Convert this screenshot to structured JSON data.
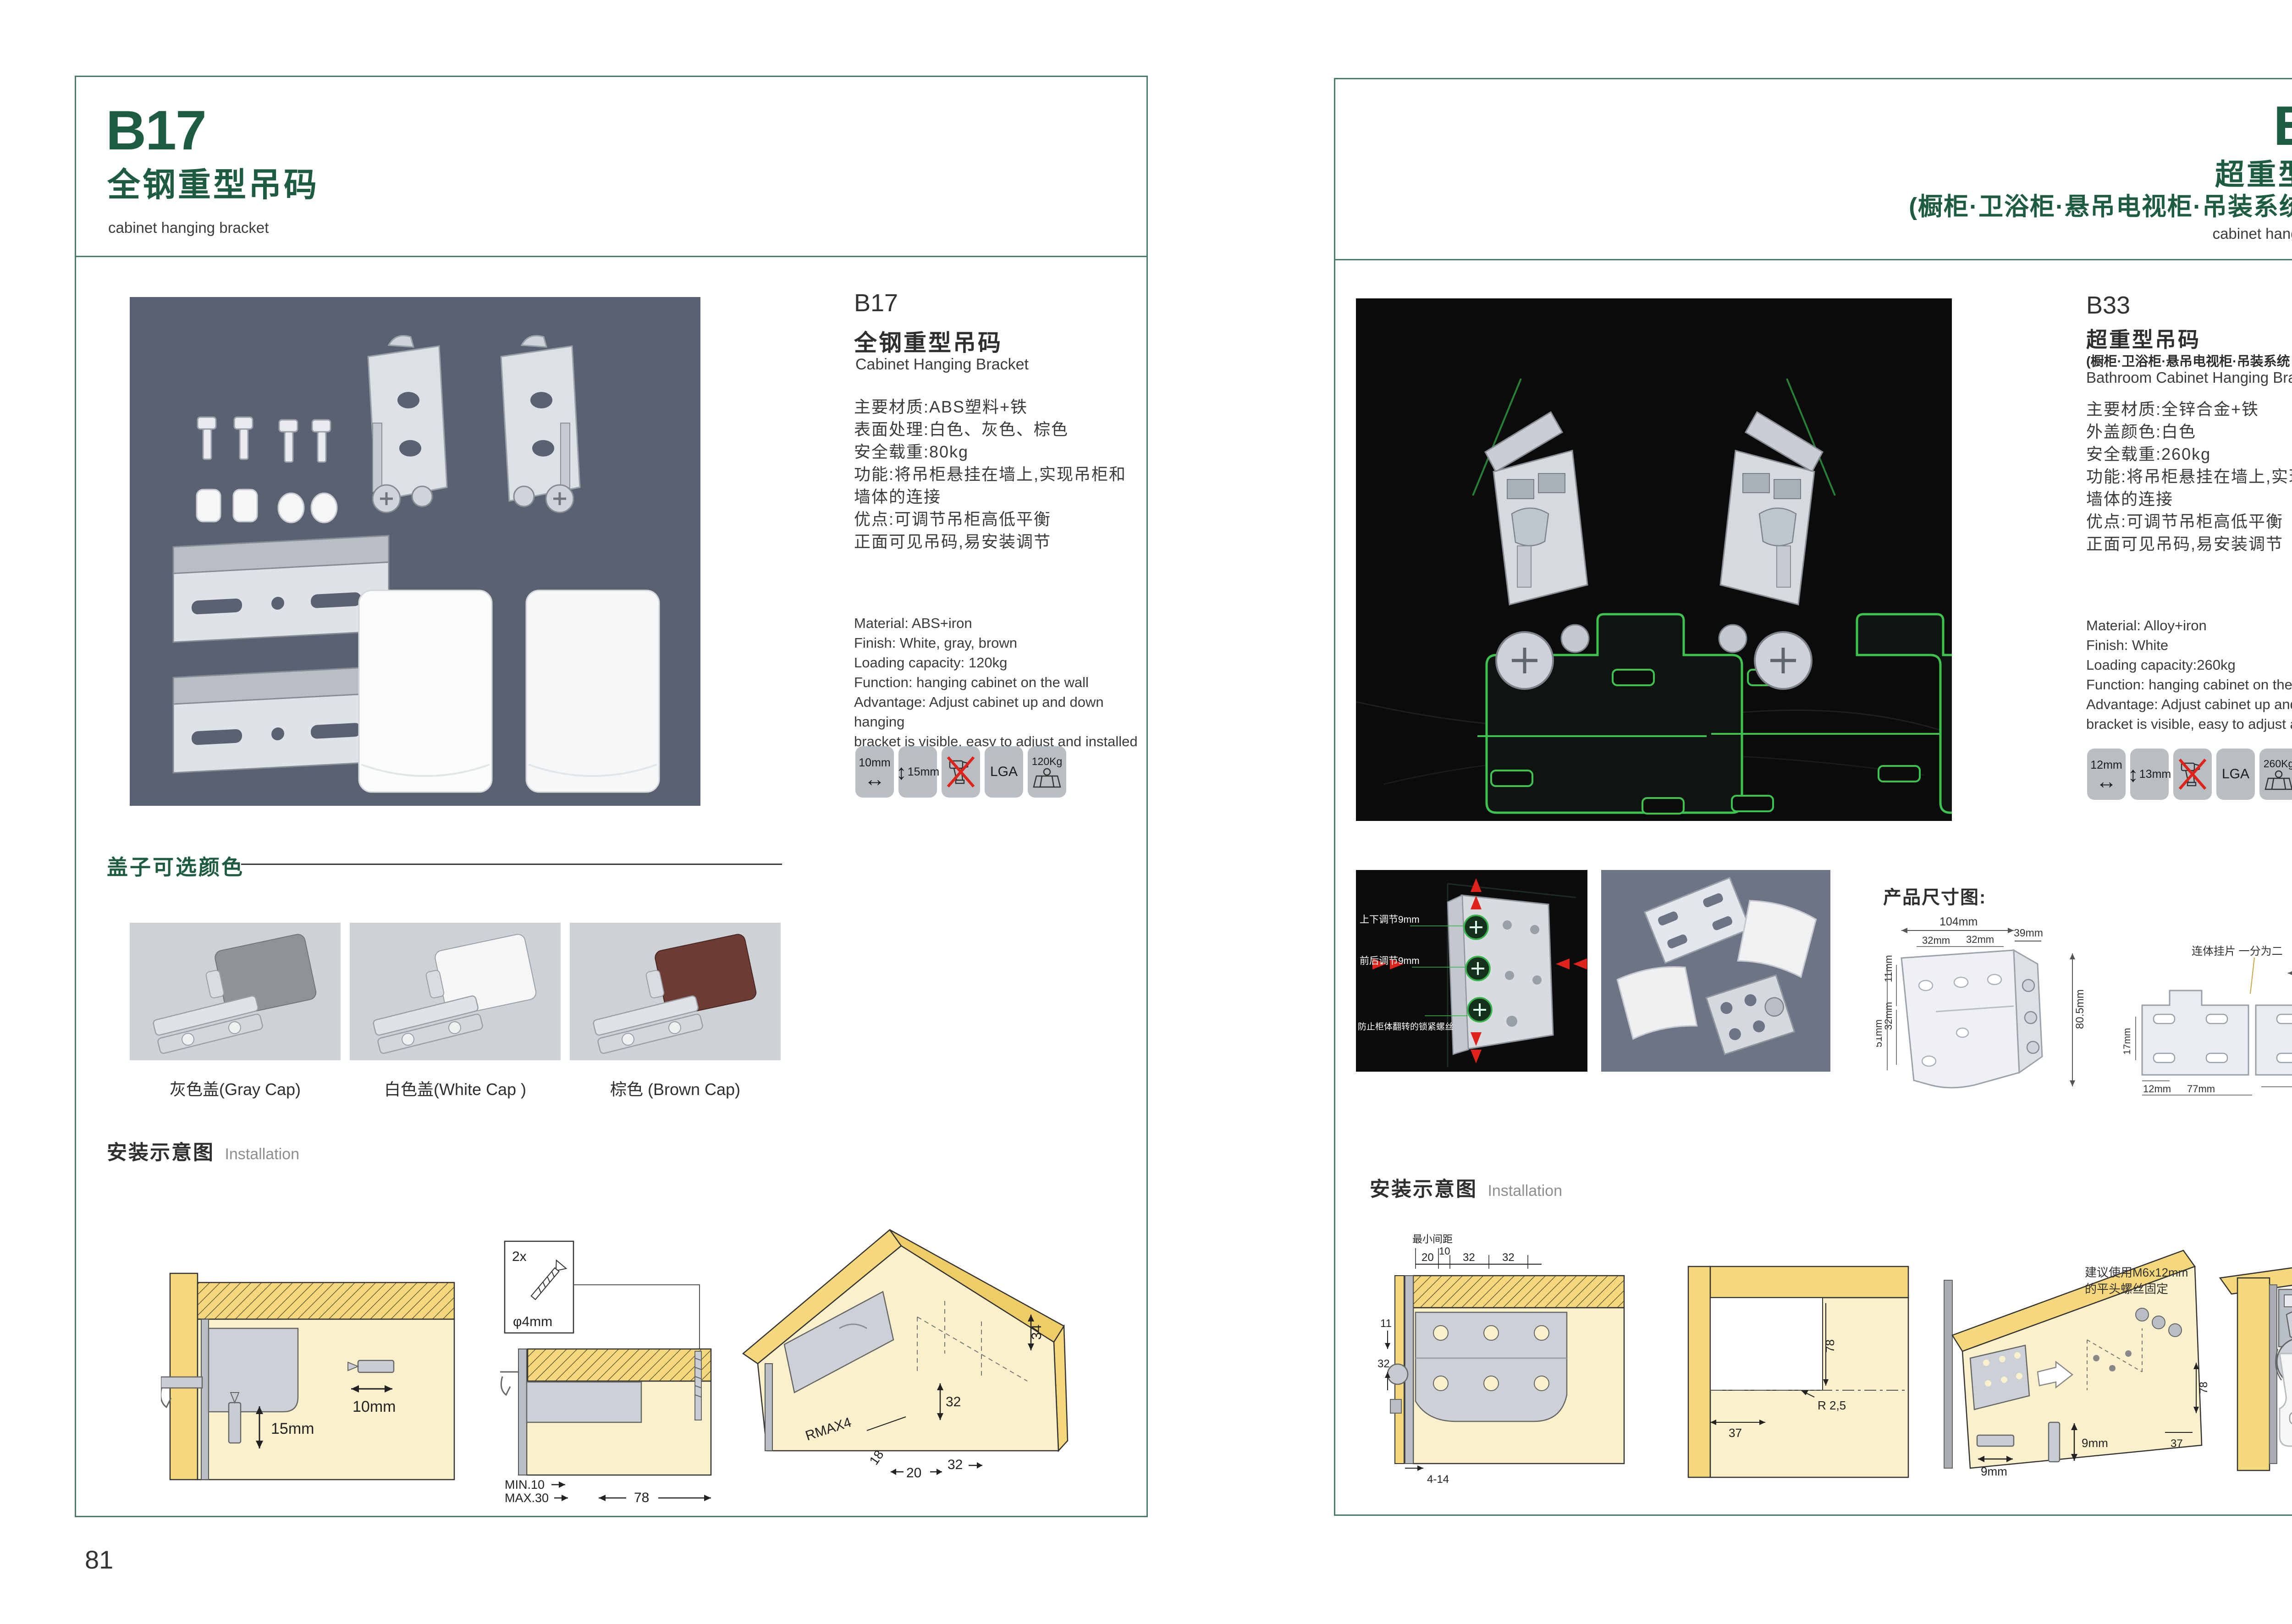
{
  "left": {
    "header": {
      "code": "B17",
      "title_cn": "全钢重型吊码",
      "subtitle_en": "cabinet hanging bracket"
    },
    "product": {
      "code": "B17",
      "name_cn": "全钢重型吊码",
      "name_en": "Cabinet Hanging Bracket",
      "specs_cn": [
        "主要材质:ABS塑料+铁",
        "表面处理:白色、灰色、棕色",
        "安全载重:80kg",
        "功能:将吊柜悬挂在墙上,实现吊柜和",
        "墙体的连接",
        "优点:可调节吊柜高低平衡",
        "正面可见吊码,易安装调节"
      ],
      "specs_en": [
        "Material: ABS+iron",
        "Finish: White, gray, brown",
        "Loading capacity: 120kg",
        "Function: hanging cabinet on the wall",
        "Advantage: Adjust cabinet up and down hanging",
        "bracket is visible, easy to adjust and installed"
      ]
    },
    "icons": {
      "i1": "10mm",
      "i2": "15mm",
      "i4": "LGA",
      "i5": "120Kg"
    },
    "caps": {
      "title": "盖子可选颜色",
      "items": [
        {
          "label": "灰色盖(Gray Cap)",
          "color": "#8f9296"
        },
        {
          "label": "白色盖(White Cap )",
          "color": "#f5f6f5"
        },
        {
          "label": "棕色 (Brown Cap)",
          "color": "#6e3b34"
        }
      ]
    },
    "install": {
      "title_cn": "安装示意图",
      "title_en": "Installation",
      "d1": {
        "dim_h": "10mm",
        "dim_v": "15mm"
      },
      "d2": {
        "qty": "2x",
        "dia": "φ4mm",
        "min": "MIN.10",
        "max": "MAX.30",
        "w": "78"
      },
      "d3": {
        "a": "34",
        "b": "32",
        "r": "RMAX4",
        "c": "18",
        "d": "20",
        "e": "32"
      }
    },
    "page_number": "81"
  },
  "right": {
    "header": {
      "code": "B33",
      "title_cn": "超重型吊码",
      "title_cn2": "(橱柜·卫浴柜·悬吊电视柜·吊装系统 专用)",
      "subtitle_en": "cabinet hanging bracket"
    },
    "product": {
      "code": "B33",
      "name_cn": "超重型吊码",
      "name_cn2": "(橱柜·卫浴柜·悬吊电视柜·吊装系统 专用)",
      "name_en": "Bathroom Cabinet Hanging Bracket",
      "specs_cn": [
        "主要材质:全锌合金+铁",
        "外盖颜色:白色",
        "安全载重:260kg",
        "功能:将吊柜悬挂在墙上,实现吊柜和",
        "墙体的连接",
        "优点:可调节吊柜高低平衡",
        "正面可见吊码,易安装调节"
      ],
      "specs_en": [
        "Material: Alloy+iron",
        "Finish: White",
        "Loading capacity:260kg",
        "Function: hanging cabinet on the wall",
        "Advantage: Adjust cabinet up and down hanging",
        "bracket is visible, easy to adjust and installed"
      ]
    },
    "icons": {
      "i1": "12mm",
      "i2": "13mm",
      "i4": "LGA",
      "i5": "260Kg"
    },
    "adjust_photo": {
      "l1": "上下调节9mm",
      "l2": "前后调节9mm",
      "l3": "防止柜体翻转的锁紧螺丝"
    },
    "dims": {
      "title": "产品尺寸图:",
      "d1": {
        "w": "104mm",
        "flange": "39mm",
        "p1": "32mm",
        "p2": "32mm",
        "l1": "11mm",
        "l2": "32mm",
        "l3": "51mm",
        "h": "80.5mm"
      },
      "d2": {
        "note": "连体挂片 一分为二",
        "top": "55mm",
        "r1": "39mm",
        "r2": "55mm",
        "r3": "8mm",
        "l1": "17mm",
        "b1": "12mm",
        "b2": "63mm",
        "b3": "77mm"
      }
    },
    "install": {
      "title_cn": "安装示意图",
      "title_en": "Installation",
      "d1": {
        "note": "最小间距",
        "t1": "20",
        "t2": "10",
        "t3": "32",
        "t4": "32",
        "l1": "11",
        "l2": "32",
        "b1": "4-14"
      },
      "d2": {
        "h": "78",
        "r": "R 2,5",
        "b": "37"
      },
      "d3": {
        "note1": "建议使用M6x12mm",
        "note2": "的平头螺丝固定",
        "bit1": "9mm",
        "bit2": "9mm",
        "dim1": "37",
        "dim2": "78"
      }
    },
    "page_number": "82"
  },
  "colors": {
    "accent_green": "#1e5c41",
    "border_green": "#4a7a68",
    "wireframe_green": "#3cc44e",
    "warn_red": "#e0231a",
    "panel_yellow": "#f6d87c",
    "panel_pale": "#faf0cb"
  }
}
